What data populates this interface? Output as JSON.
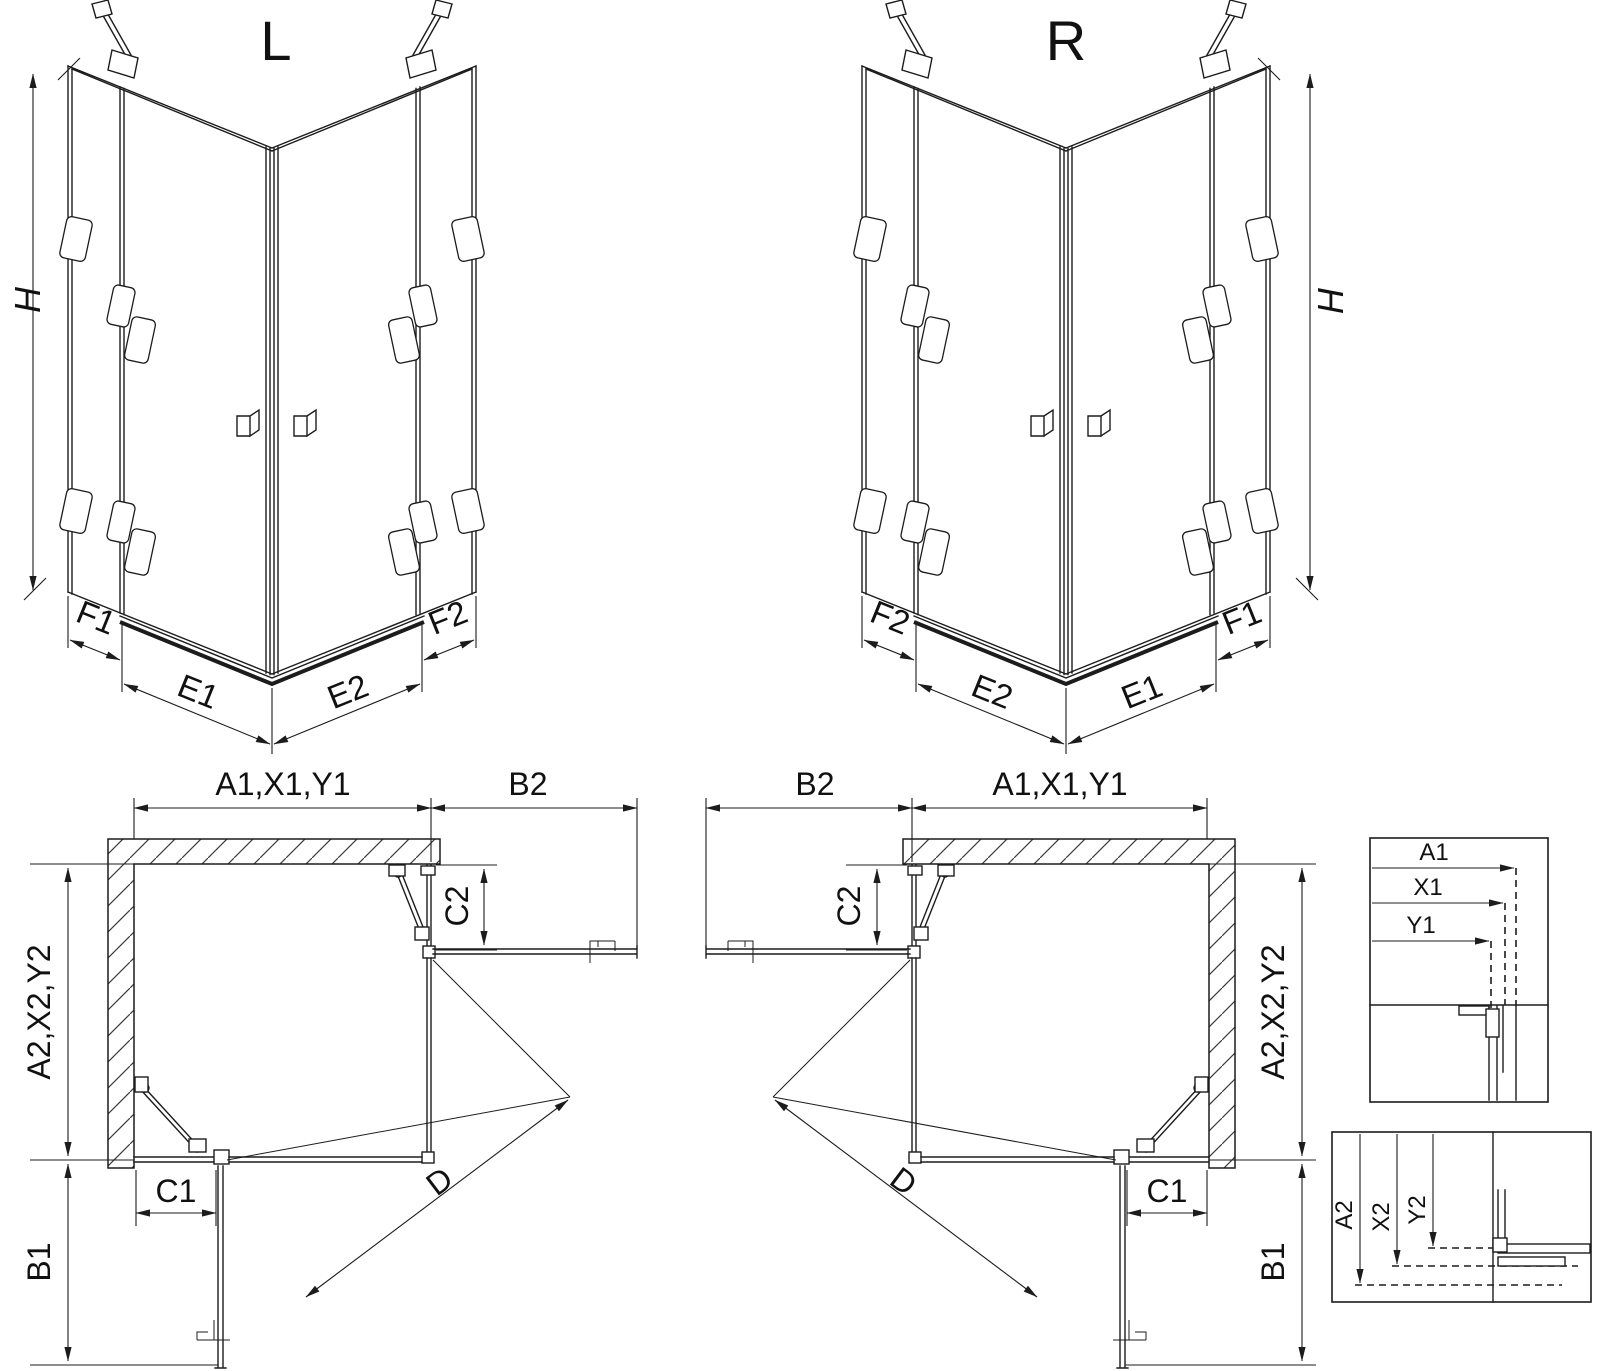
{
  "colors": {
    "line": "#1c1c1c",
    "background": "#ffffff"
  },
  "iso_left": {
    "title": "L",
    "height_label": "H",
    "f1": "F1",
    "e1": "E1",
    "e2": "E2",
    "f2": "F2"
  },
  "iso_right": {
    "title": "R",
    "height_label": "H",
    "f1": "F1",
    "e1": "E1",
    "e2": "E2",
    "f2": "F2"
  },
  "plan_left": {
    "top_width": "A1,X1,Y1",
    "return_width": "B2",
    "side_depth": "A2,X2,Y2",
    "fixed_c2": "C2",
    "fixed_c1": "C1",
    "return_depth": "B1",
    "entry_diagonal": "D"
  },
  "plan_right": {
    "top_width": "A1,X1,Y1",
    "return_width": "B2",
    "side_depth": "A2,X2,Y2",
    "fixed_c2": "C2",
    "fixed_c1": "C1",
    "return_depth": "B1",
    "entry_diagonal": "D"
  },
  "detail_top": {
    "rows": [
      "A1",
      "X1",
      "Y1"
    ]
  },
  "detail_bottom": {
    "rows": [
      "A2",
      "X2",
      "Y2"
    ]
  }
}
